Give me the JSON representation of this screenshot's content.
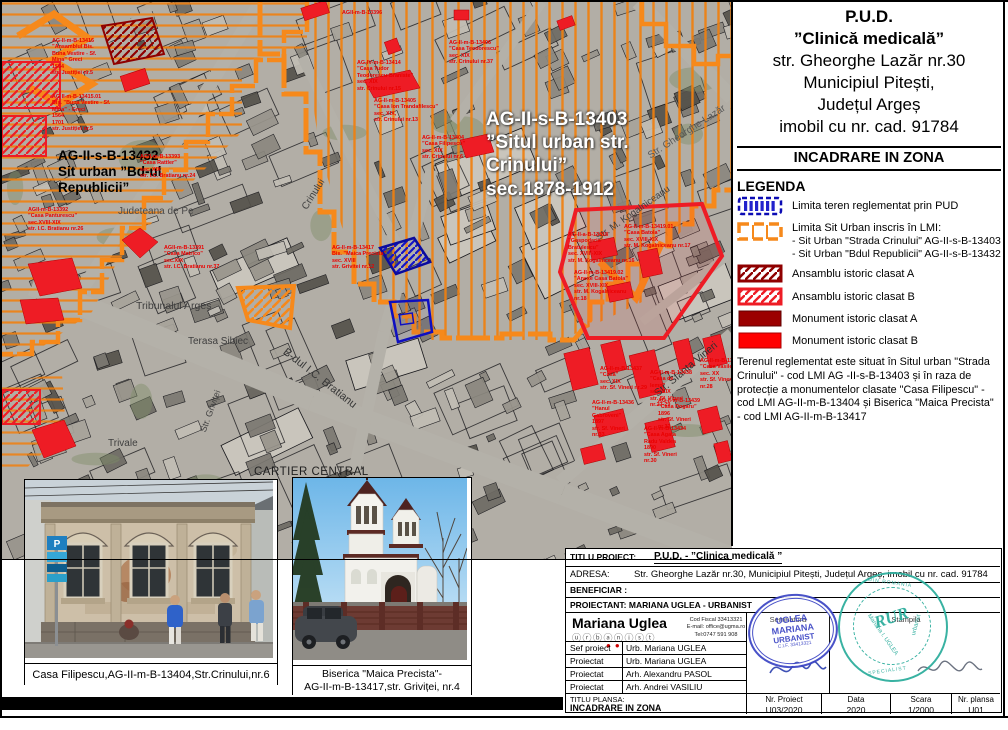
{
  "doc": {
    "title1": "P.U.D.",
    "title2": "”Clinică medicală”",
    "title3": "str. Gheorghe Lazăr nr.30",
    "title4": "Municipiul Pitești,",
    "title5": "Județul Argeș",
    "title6": "imobil cu nr. cad. 91784",
    "section_header": "INCADRARE IN ZONA"
  },
  "legend": {
    "heading": "LEGENDA",
    "item1": "Limita teren reglementat prin PUD",
    "item2": "Limita Sit Urban inscris în LMI:",
    "item2_sub1": "- Sit Urban \"Strada Crinului\" AG-II-s-B-13403",
    "item2_sub2": "- Sit Urban \"Bdul Republicii\" AG-II-s-B-13432",
    "item3": "Ansamblu istoric clasat A",
    "item4": "Ansamblu istoric clasat B",
    "item5": "Monument istoric clasat A",
    "item6": "Monument istoric clasat B",
    "note": "Terenul reglementat este situat în Situl urban \"Strada Crinului\" - cod LMI AG -II-s-B-13403 și în raza de protecție a monumentelor clasate \"Casa Filipescu\" - cod LMI AG-II-m-B-13404  și Biserica \"Maica Precista\" - cod LMI AG-II-m-B-13417"
  },
  "map": {
    "site_label_crinului": "AG-II-s-B-13403\n”Situl urban str.\nCrinului”\nsec.1878-1912",
    "site_label_republicii": "AG-II-s-B-13432\nSit urban ”Bd-ul\nRepublicii”",
    "gray_labels": [
      "Tribunalul Argeș",
      "Terasa Sibiec",
      "CARTIER CENTRAL",
      "Trivale",
      "Judeteana de Pe",
      "B-dul I.C. Bratianu",
      "Str. M. Kogalniceanu",
      "Str. Sfanta Vineri",
      "Str. Gheorghe Lazăr",
      "Crinului",
      "Str. Griviței"
    ],
    "red_labels": [
      "AG-II-m-B-13416\n”Ansamblul Bis.\nBuna Vestire - Sf.\nMina” Greci\n1564\nstr. Justiției nr.5",
      "AG II-m-B-13415.01\nBis. ”Buna Vestire - Sf.\nMina” - Greci\n1564\n1701\nstr. Justiției nr.5",
      "AGII-m-B-13393\n”Casa Rattler”\nsec. XIX\nstr. I.C. Bratianu nr.24",
      "AGII-m-B-13392\n”Casa Panturescu”\nsec.XVIII-XIX\nstr. I.C. Bratianu nr.26",
      "AGII-m-B-13391\n”Casa Matrico”\nsec.XIX\nstr. I.C. Bratianu nr.37",
      "AGII-m-B-13396",
      "AG-IV-m-B-13414\n”Casa Tudor\nTeodorescu-Braniste”\nsec. XIX\nstr. Crinului nr.15",
      "AG-II-m-B-13405\n”Casa Ion Trandafilescu”\nsec. XIX,\nstr. Crinului nr.13",
      "AG-II-m-B-13404\n”Casa Filipescu”\nsec. XIX\nstr. Crinului nr.6",
      "AG-II-m-B-13406\n”Casa Teodorescu”\nsec. XIX\nstr. Crinului nr.37",
      "AG-II-m-B-13417\nBis. ”Maica Precista”\nsec. XVIII\nstr. Grivitei nr.12",
      "AG-II-a-B-13418\n”Gospodaria\nBratulescu”\nsec. XVIII-XIX\nstr. M. Kogalniceanu nr.16",
      "AG-II-m-B-13419.01\n”Casa Batola”\nsec. XVIII-XIX\nstr. M. Kogalniceanu nr.17",
      "AG-II-m-B-13419.02\n”Anexe Casa Batola”\nsec. XVIII-XIX\nstr. M. Kogalniceanu\nnr.18",
      "AG-II-m-B-13437\n”Casa”\nsec. XIX\nstr. Sf. Vineri nr.29",
      "AG-II-m-B-13438\n”Casa de\nlemn”\nsec. XIX\nstr. Sf. Vineri\nnr.27-29",
      "AG-II-m-B-13435\n”Casa Vasile”\nsec. XX\nstr. Sf. Vineri\nnr.28",
      "AG-II-m-B-13436\n”Hanul\nGabroveni”\n1897\nstr. Sf. Vineri\nnr.33",
      "AG-II-m-B-13439\n”Casa Dogaru”\n1896\nstr. Sf. Vineri\nnr.32",
      "AG-II-m-B-13434\n”Casa Agata\nRadu Valdea\n1890\nstr. Sf. Vineri\nnr.30"
    ]
  },
  "photos": {
    "casa_caption": "Casa Filipescu,AG-II-m-B-13404,Str.Crinului,nr.6",
    "biserica_caption1": "Biserica \"Maica Precista\"-",
    "biserica_caption2": "AG-II-m-B-13417,str. Griviței, nr.4"
  },
  "cartouche": {
    "titlu_proiect_label": "TITLU PROIECT:",
    "titlu_proiect_value": "P.U.D. - ”Clinica medicală ”",
    "adresa_label": "ADRESA:",
    "adresa_value": "Str. Gheorghe Lazăr nr.30, Municipiul Pitești, Județul Argeș, imobil cu nr. cad. 91784",
    "beneficiar_label": "BENEFICIAR :",
    "proiectant_label": "PROIECTANT: MARIANA UGLEA - URBANIST",
    "logo_name": "Mariana Uglea",
    "logo_sub": "ⓤⓡⓑⓐⓝⓘⓢⓣ",
    "contact1": "Cod Fiscal 33413321",
    "contact2": "E-mail: office@ugma.ro",
    "contact3": "Tel:0747 591 908",
    "semnatura_header": "Semnatura",
    "stampila_header": "Stampila",
    "rows": [
      {
        "role": "Sef proiect",
        "name": "Urb. Mariana UGLEA"
      },
      {
        "role": "Proiectat",
        "name": "Urb. Mariana UGLEA"
      },
      {
        "role": "Proiectat",
        "name": "Arh. Alexandru PASOL"
      },
      {
        "role": "Proiectat",
        "name": "Arh. Andrei VASILIU"
      }
    ],
    "titlu_plansa_label": "TITLU PLANSA:",
    "titlu_plansa_value": "INCADRARE IN ZONA",
    "nr_proiect_label": "Nr. Proiect",
    "nr_proiect_value": "U03/2020",
    "data_label": "Data",
    "data_value": "2020",
    "scara_label": "Scara",
    "scara_value": "1/2000",
    "nr_plansa_label": "Nr. plansa",
    "nr_plansa_value": "U01",
    "stamp_blue1": "UGLEA",
    "stamp_blue2": "MARIANA",
    "stamp_blue3": "URBANIST",
    "stamp_blue4": "C.I.F. 33413321",
    "stamp_teal_center": "RUR",
    "stamp_teal_name": "Mariana I. UGLEA",
    "stamp_teal_role": "urbanist",
    "stamp_teal_top": "DIN ROMANIA",
    "stamp_teal_bottom": "SPECIALIST"
  },
  "colors": {
    "orange": "#F6891B",
    "red": "#EE1C25",
    "dark_red": "#9B0000",
    "blue": "#1414B4",
    "teal": "#2FAE9E"
  }
}
